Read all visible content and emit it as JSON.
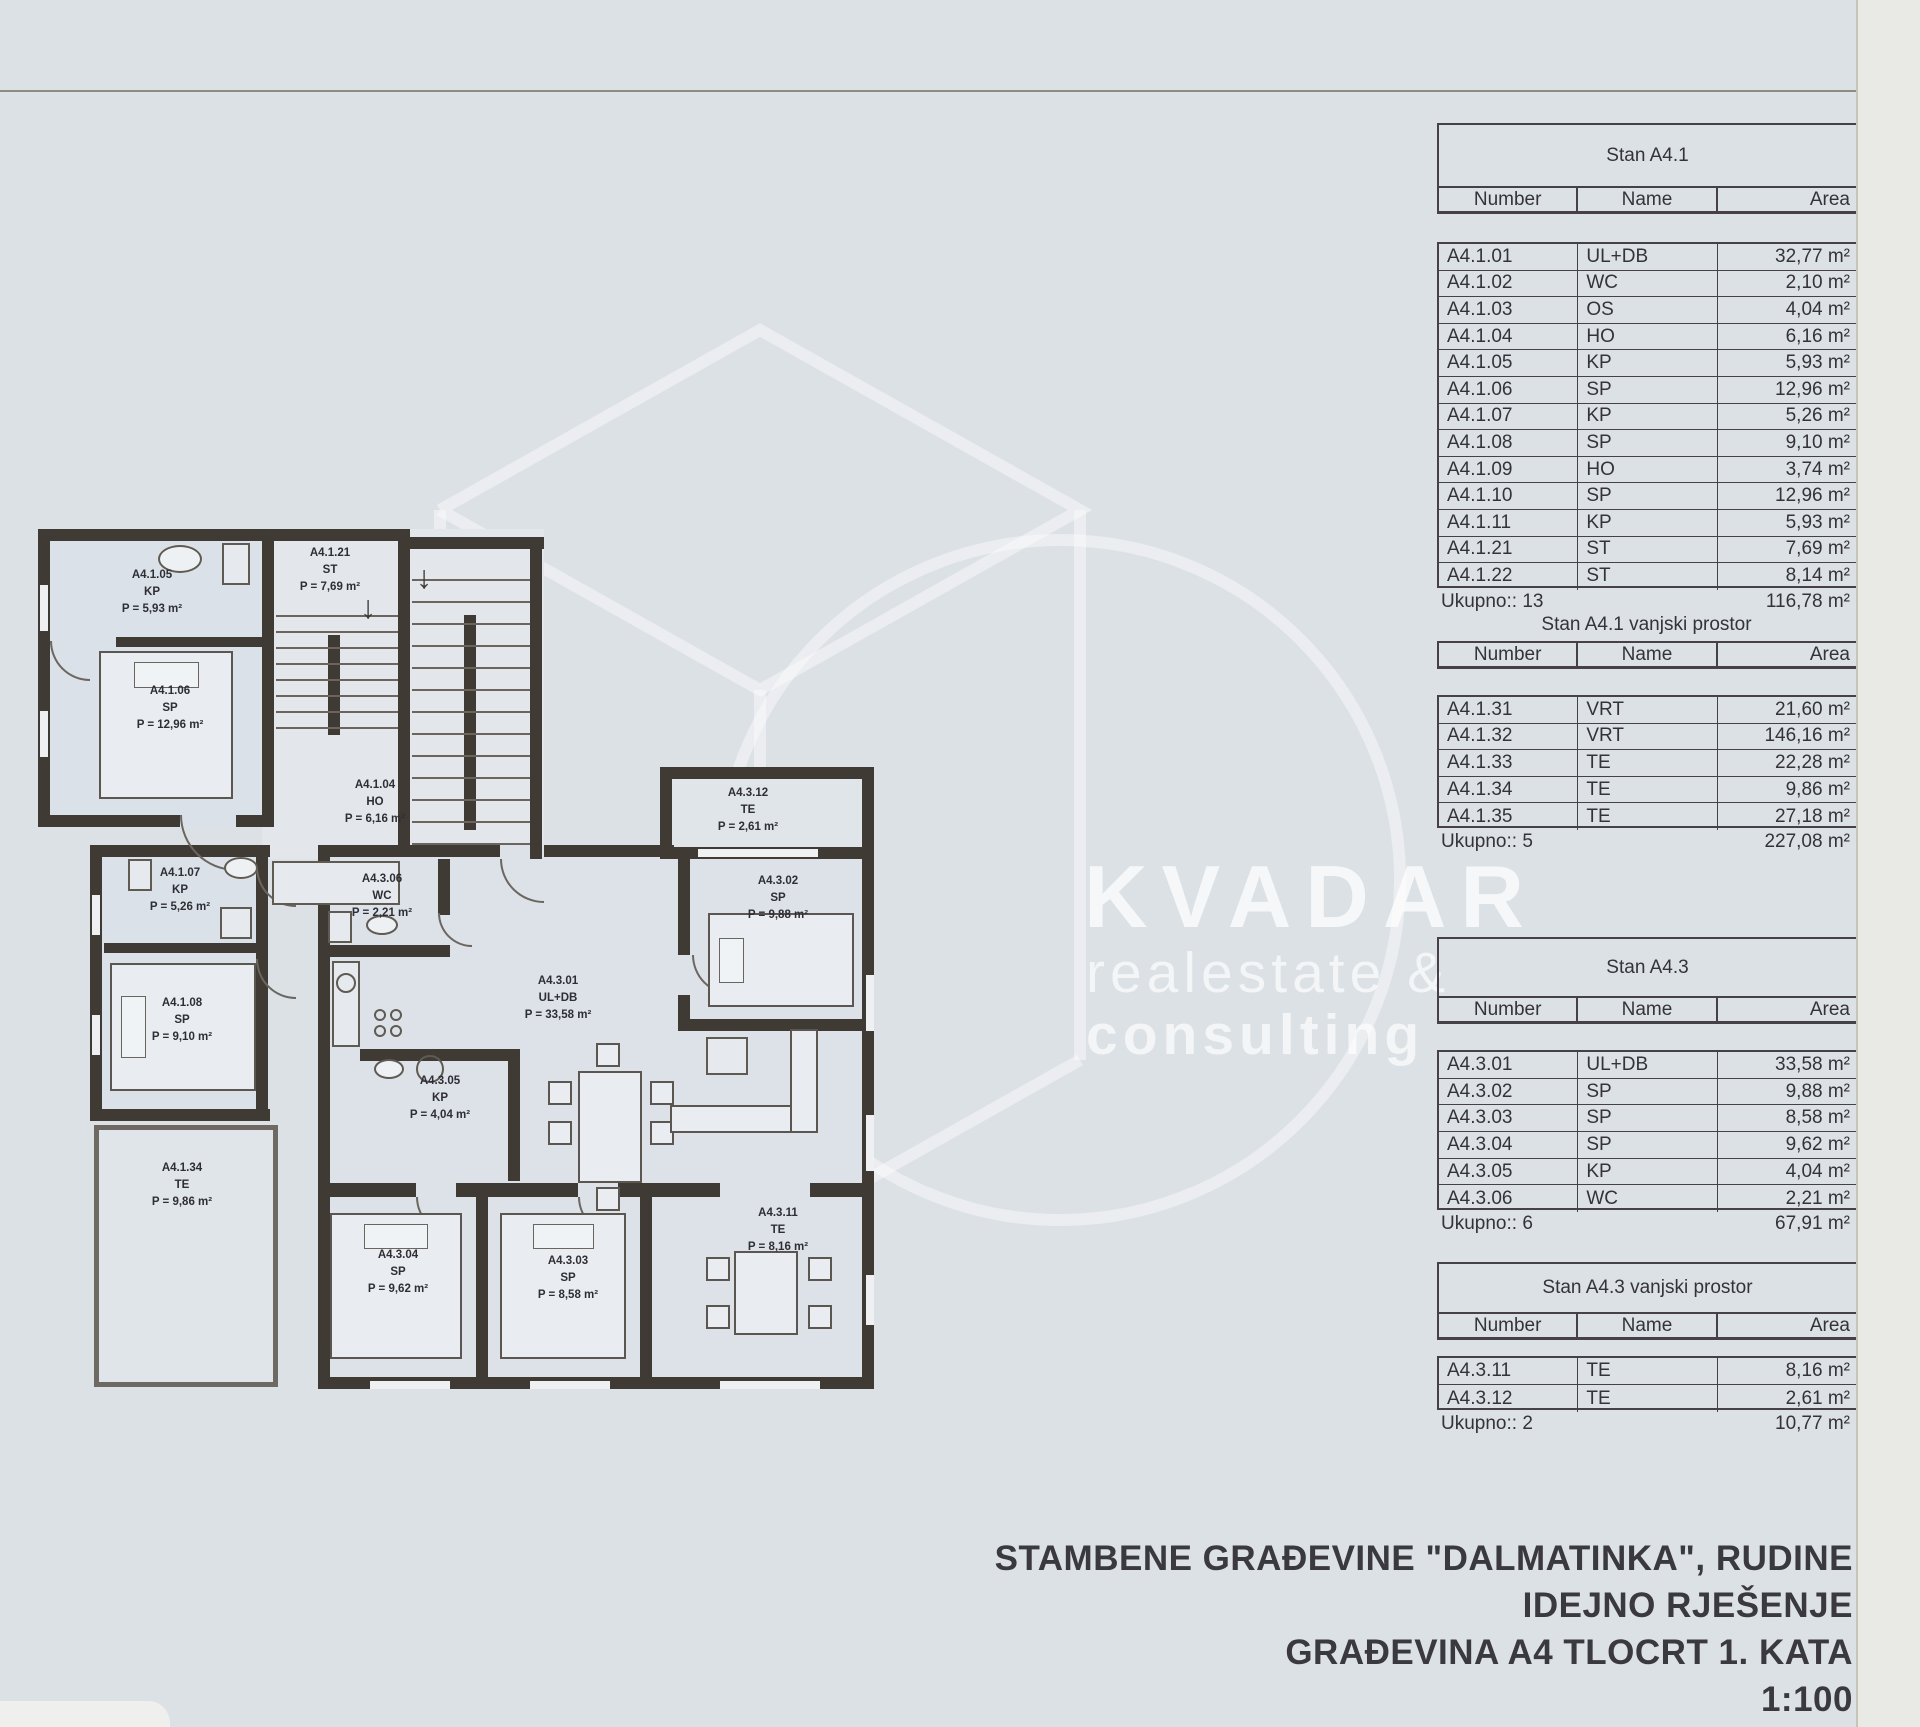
{
  "watermark": {
    "line1": "KVADAR",
    "line2": "realestate &",
    "line3": "consulting"
  },
  "title_block": {
    "line1": "STAMBENE GRAĐEVINE \"DALMATINKA\", RUDINE",
    "line2": "IDEJNO RJEŠENJE",
    "line3": "GRAĐEVINA A4 TLOCRT 1. KATA",
    "scale": "1:100"
  },
  "tables": [
    {
      "title": "Stan A4.1",
      "columns": [
        "Number",
        "Name",
        "Area"
      ],
      "rows": [
        [
          "A4.1.01",
          "UL+DB",
          "32,77 m²"
        ],
        [
          "A4.1.02",
          "WC",
          "2,10 m²"
        ],
        [
          "A4.1.03",
          "OS",
          "4,04 m²"
        ],
        [
          "A4.1.04",
          "HO",
          "6,16 m²"
        ],
        [
          "A4.1.05",
          "KP",
          "5,93 m²"
        ],
        [
          "A4.1.06",
          "SP",
          "12,96 m²"
        ],
        [
          "A4.1.07",
          "KP",
          "5,26 m²"
        ],
        [
          "A4.1.08",
          "SP",
          "9,10 m²"
        ],
        [
          "A4.1.09",
          "HO",
          "3,74 m²"
        ],
        [
          "A4.1.10",
          "SP",
          "12,96 m²"
        ],
        [
          "A4.1.11",
          "KP",
          "5,93 m²"
        ],
        [
          "A4.1.21",
          "ST",
          "7,69 m²"
        ],
        [
          "A4.1.22",
          "ST",
          "8,14 m²"
        ]
      ],
      "total_label": "Ukupno:: 13",
      "total_area": "116,78 m²"
    },
    {
      "title": "Stan A4.1 vanjski prostor",
      "columns": [
        "Number",
        "Name",
        "Area"
      ],
      "rows": [
        [
          "A4.1.31",
          "VRT",
          "21,60 m²"
        ],
        [
          "A4.1.32",
          "VRT",
          "146,16 m²"
        ],
        [
          "A4.1.33",
          "TE",
          "22,28 m²"
        ],
        [
          "A4.1.34",
          "TE",
          "9,86 m²"
        ],
        [
          "A4.1.35",
          "TE",
          "27,18 m²"
        ]
      ],
      "total_label": "Ukupno:: 5",
      "total_area": "227,08 m²"
    },
    {
      "title": "Stan A4.3",
      "columns": [
        "Number",
        "Name",
        "Area"
      ],
      "rows": [
        [
          "A4.3.01",
          "UL+DB",
          "33,58 m²"
        ],
        [
          "A4.3.02",
          "SP",
          "9,88 m²"
        ],
        [
          "A4.3.03",
          "SP",
          "8,58 m²"
        ],
        [
          "A4.3.04",
          "SP",
          "9,62 m²"
        ],
        [
          "A4.3.05",
          "KP",
          "4,04 m²"
        ],
        [
          "A4.3.06",
          "WC",
          "2,21 m²"
        ]
      ],
      "total_label": "Ukupno:: 6",
      "total_area": "67,91 m²"
    },
    {
      "title": "Stan A4.3 vanjski prostor",
      "columns": [
        "Number",
        "Name",
        "Area"
      ],
      "rows": [
        [
          "A4.3.11",
          "TE",
          "8,16 m²"
        ],
        [
          "A4.3.12",
          "TE",
          "2,61 m²"
        ]
      ],
      "total_label": "Ukupno:: 2",
      "total_area": "10,77 m²"
    }
  ],
  "plan": {
    "rooms": [
      {
        "code": "A4.1.05",
        "name": "KP",
        "area": "P = 5,93 m²"
      },
      {
        "code": "A4.1.21",
        "name": "ST",
        "area": "P = 7,69 m²"
      },
      {
        "code": "A4.1.06",
        "name": "SP",
        "area": "P = 12,96 m²"
      },
      {
        "code": "A4.1.04",
        "name": "HO",
        "area": "P = 6,16 m²"
      },
      {
        "code": "A4.1.07",
        "name": "KP",
        "area": "P = 5,26 m²"
      },
      {
        "code": "A4.1.08",
        "name": "SP",
        "area": "P = 9,10 m²"
      },
      {
        "code": "A4.1.34",
        "name": "TE",
        "area": "P = 9,86 m²"
      },
      {
        "code": "A4.3.06",
        "name": "WC",
        "area": "P = 2,21 m²"
      },
      {
        "code": "A4.3.12",
        "name": "TE",
        "area": "P = 2,61 m²"
      },
      {
        "code": "A4.3.01",
        "name": "UL+DB",
        "area": "P = 33,58 m²"
      },
      {
        "code": "A4.3.02",
        "name": "SP",
        "area": "P = 9,88 m²"
      },
      {
        "code": "A4.3.05",
        "name": "KP",
        "area": "P = 4,04 m²"
      },
      {
        "code": "A4.3.04",
        "name": "SP",
        "area": "P = 9,62 m²"
      },
      {
        "code": "A4.3.03",
        "name": "SP",
        "area": "P = 8,58 m²"
      },
      {
        "code": "A4.3.11",
        "name": "TE",
        "area": "P = 8,16 m²"
      }
    ]
  }
}
